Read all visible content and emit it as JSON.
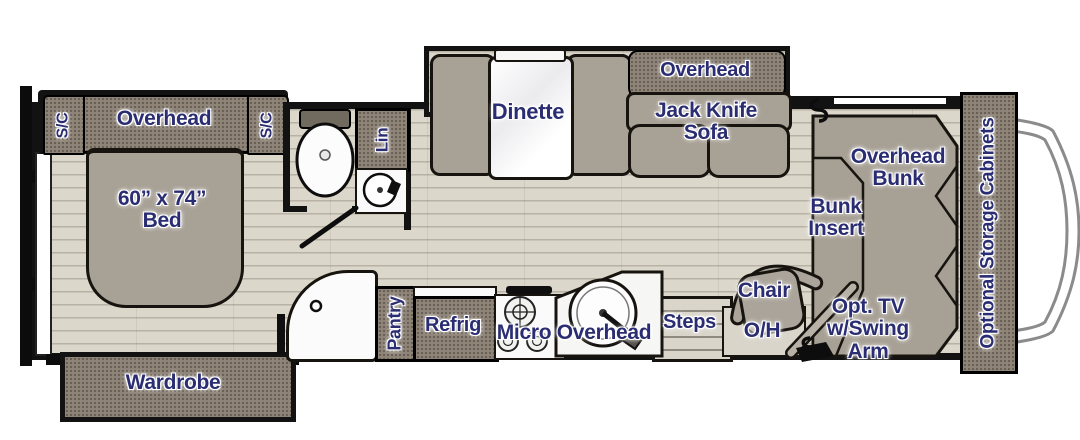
{
  "labels": {
    "sc_left": "S/C",
    "bedroom_overhead": "Overhead",
    "sc_right": "S/C",
    "bed": "60” x 74”\nBed",
    "linen": "Lin",
    "wardrobe": "Wardrobe",
    "dinette": "Dinette",
    "sofa_overhead": "Overhead",
    "jack_knife_sofa": "Jack Knife\nSofa",
    "pantry": "Pantry",
    "refrig": "Refrig",
    "micro_overhead": "Micro Overhead",
    "steps": "Steps",
    "chair": "Chair",
    "chair_oh": "O/H",
    "opt_tv": "Opt. TV\nw/Swing\nArm",
    "overhead_bunk": "Overhead\nBunk",
    "bunk_insert": "Bunk\nInsert",
    "storage": "Optional Storage Cabinets"
  },
  "colors": {
    "label_navy": "#2b2d72",
    "cabinet_taupe": "#8e8478",
    "cushion_gray": "#a8a196",
    "floor_light": "#dcd7cb",
    "wall_black": "#121212",
    "fixture_white": "#fafafa"
  }
}
